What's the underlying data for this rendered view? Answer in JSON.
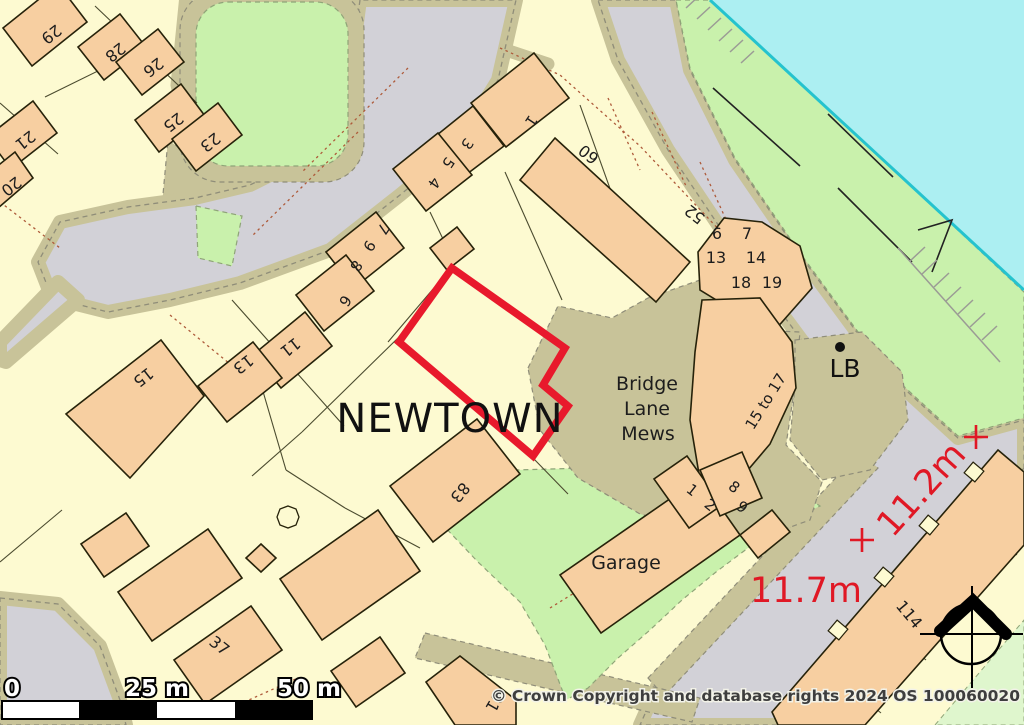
{
  "map": {
    "place_name": "NEWTOWN",
    "area_labels": {
      "bridge": "Bridge",
      "lane": "Lane",
      "mews": "Mews",
      "garage": "Garage",
      "lb": "LB",
      "flats_15_17": "15 to 17"
    },
    "house_numbers": {
      "h29": "29",
      "h28": "28",
      "h26": "26",
      "h25": "25",
      "h23": "23",
      "h21": "21",
      "h20": "20",
      "h15": "15",
      "h13": "13",
      "h11": "11",
      "h1": "1",
      "h3": "3",
      "h5": "5",
      "h4": "4",
      "h7": "7",
      "h9": "9",
      "h8": "8",
      "h6": "6",
      "h60": "60",
      "h52": "52",
      "h83": "83",
      "h37": "37",
      "h81": "81",
      "h114": "114"
    },
    "flat_numbers": {
      "f6": "6",
      "f7": "7",
      "f13": "13",
      "f14": "14",
      "f18": "18",
      "f19": "19",
      "g1": "1",
      "g2": "2",
      "g8": "8",
      "g9": "9"
    },
    "measurements": {
      "width": "11.2m",
      "depth": "11.7m"
    },
    "scale_bar": {
      "zero": "0",
      "mid": "25 m",
      "end": "50 m"
    },
    "copyright": "© Crown Copyright and database rights 2024 OS 100060020",
    "colors": {
      "plot_outline": "#E8192C",
      "measurement_text": "#E01825",
      "building_fill": "#F7CFA1",
      "road_fill": "#D2D1D7",
      "verge_fill": "#C8C399",
      "green_fill": "#C9F1AC",
      "water_fill": "#ACEFF2"
    }
  }
}
